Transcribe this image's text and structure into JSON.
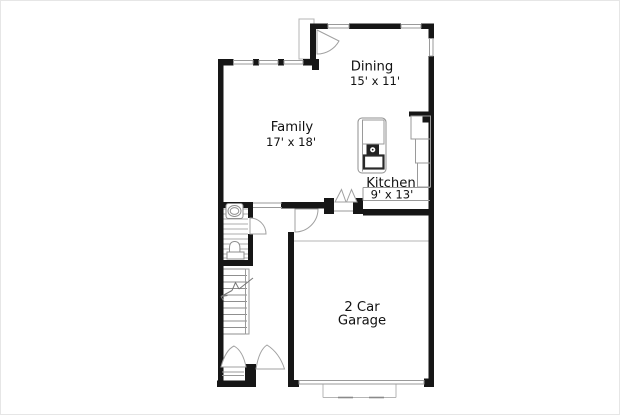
{
  "plan": {
    "type": "residential-floor-plan",
    "rooms": {
      "dining": {
        "name": "Dining",
        "dims": "15' x 11'"
      },
      "family": {
        "name": "Family",
        "dims": "17' x 18'"
      },
      "kitchen": {
        "name": "Kitchen",
        "dims": "9' x 13'"
      },
      "garage": {
        "name_line1": "2 Car",
        "name_line2": "Garage"
      }
    },
    "fixtures": [
      "pedestal-sink",
      "toilet",
      "staircase-up-arrow",
      "range-island",
      "kitchen-counter",
      "double-closet-door",
      "interior-door-swings",
      "front-door-swing",
      "entry-stoop",
      "garage-door",
      "driveway-apron",
      "windows"
    ],
    "colors": {
      "wall": "#161616",
      "thin_line": "#9a9a9a",
      "text": "#111111",
      "background": "#ffffff"
    }
  }
}
